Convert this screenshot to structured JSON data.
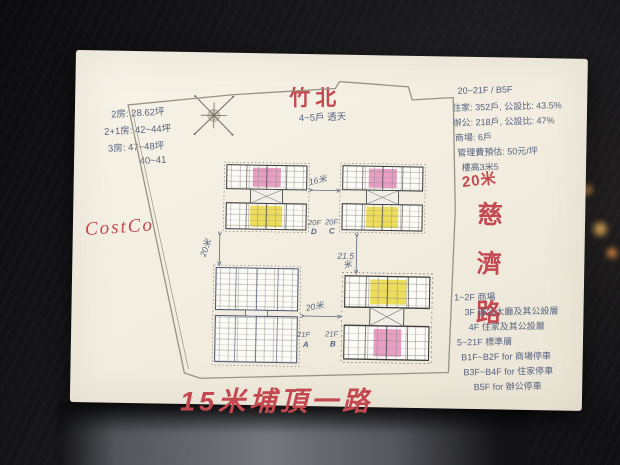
{
  "paper": {
    "region": "竹北",
    "region_note": "4~5戶 透天",
    "left_label": "CostCo",
    "top_left_notes": [
      "2房: 28.62坪",
      "2+1房: 42~44坪",
      "3房: 47~48坪",
      "40~41"
    ],
    "top_right_notes": [
      "20~21F / B5F",
      "住家: 352戶, 公設比: 43.5%",
      "辦公: 218戶, 公設比: 47%",
      "商場: 6戶",
      "管理費預估: 50元/坪",
      "樓高3米5"
    ],
    "right_road": {
      "width": "20米",
      "chars": [
        "慈",
        "濟",
        "路"
      ]
    },
    "bottom_road": "15米埔頂一路",
    "floor_legend": [
      "1~2F 商場",
      "3F 辦公大廳及其公設層",
      "4F 住家及其公設層",
      "5~21F 標準層",
      "B1F~B2F for 商場停車",
      "B3F~B4F for 住家停車",
      "B5F for 辦公停車"
    ],
    "site": {
      "dim_between_top": "16米",
      "dim_left": "20米",
      "dim_right_value": "21.5",
      "dim_right_unit": "米",
      "dim_between_bottom": "20米",
      "buildings": [
        {
          "floors": "20F",
          "id": "D"
        },
        {
          "floors": "20F",
          "id": "C"
        },
        {
          "floors": "21F",
          "id": "A"
        },
        {
          "floors": "21F",
          "id": "B"
        }
      ]
    },
    "ink": {
      "blue": "#57627f",
      "red": "#c4484f",
      "unit_pink": "#e79ec2",
      "unit_yellow": "#ecd94a"
    }
  }
}
